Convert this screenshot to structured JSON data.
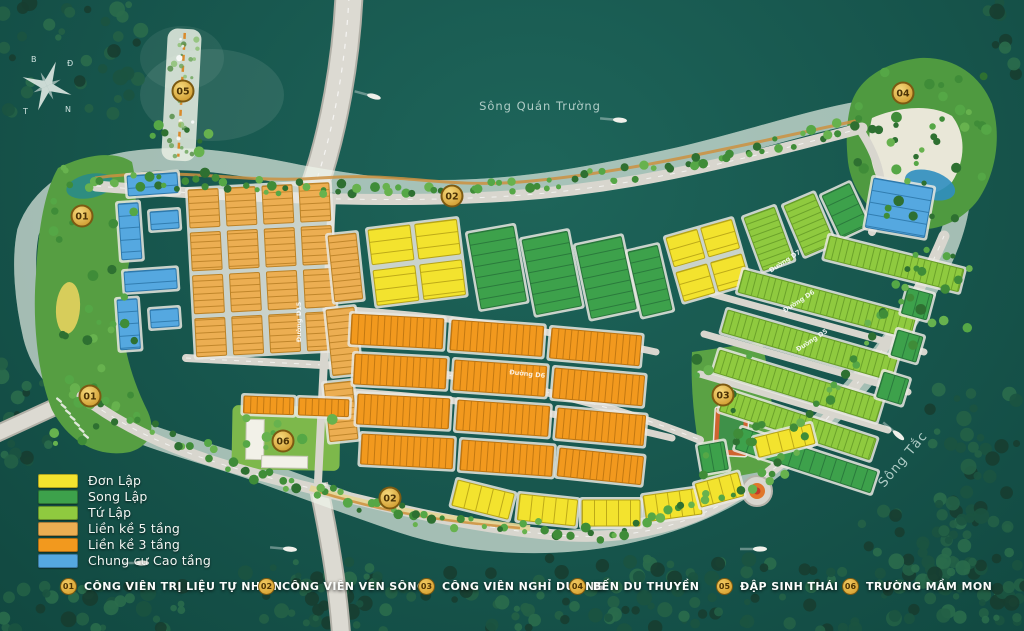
{
  "water_labels": [
    {
      "text": "Sông Quán Trường",
      "x": 540,
      "y": 110,
      "rot": 0,
      "size": 11.5
    },
    {
      "text": "Sông Tắc",
      "x": 906,
      "y": 462,
      "rot": -50,
      "size": 13
    }
  ],
  "compass": {
    "n": "B",
    "e": "Đ",
    "s": "N",
    "w": "T"
  },
  "legend": {
    "items": [
      {
        "type": "don_lap",
        "label": "Đơn Lập"
      },
      {
        "type": "song_lap",
        "label": "Song Lập"
      },
      {
        "type": "tu_lap",
        "label": "Tứ Lập"
      },
      {
        "type": "lien_ke_5",
        "label": "Liền kề 5 tầng"
      },
      {
        "type": "lien_ke_3",
        "label": "Liền kề 3 tầng"
      },
      {
        "type": "chung_cu",
        "label": "Chung cư Cao tầng"
      }
    ]
  },
  "amenities": [
    {
      "num": "01",
      "label": "CÔNG VIÊN TRỊ LIỆU TỰ NHIÊN"
    },
    {
      "num": "02",
      "label": "CÔNG VIÊN VEN SÔNG"
    },
    {
      "num": "03",
      "label": "CÔNG VIÊN NGHỈ DƯỠNG"
    },
    {
      "num": "04",
      "label": "BẾN DU THUYỀN"
    },
    {
      "num": "05",
      "label": "ĐẬP SINH THÁI"
    },
    {
      "num": "06",
      "label": "TRƯỜNG MẦM MON"
    }
  ],
  "markers": [
    {
      "num": "01",
      "x": 82,
      "y": 216
    },
    {
      "num": "01",
      "x": 90,
      "y": 396
    },
    {
      "num": "02",
      "x": 452,
      "y": 196
    },
    {
      "num": "02",
      "x": 390,
      "y": 498
    },
    {
      "num": "03",
      "x": 723,
      "y": 395
    },
    {
      "num": "04",
      "x": 903,
      "y": 93
    },
    {
      "num": "05",
      "x": 183,
      "y": 91
    },
    {
      "num": "06",
      "x": 283,
      "y": 441
    }
  ],
  "road_labels": [
    {
      "text": "Đường D15",
      "x": 301,
      "y": 322,
      "rot": -90
    },
    {
      "text": "Đường D6",
      "x": 527,
      "y": 376,
      "rot": 6
    },
    {
      "text": "Đường D7",
      "x": 786,
      "y": 263,
      "rot": -33
    },
    {
      "text": "Đường D6",
      "x": 800,
      "y": 303,
      "rot": -33
    },
    {
      "text": "Đường D5",
      "x": 813,
      "y": 342,
      "rot": -33
    }
  ],
  "colors": {
    "don_lap": {
      "fill": "#f3e32e",
      "line": "#b7a415"
    },
    "song_lap": {
      "fill": "#3da14b",
      "line": "#27763a"
    },
    "tu_lap": {
      "fill": "#8fca3f",
      "line": "#679e27"
    },
    "lien_ke_5": {
      "fill": "#ecae52",
      "line": "#bb8226"
    },
    "lien_ke_3": {
      "fill": "#f2991e",
      "line": "#bd7410"
    },
    "chung_cu": {
      "fill": "#55a8e0",
      "line": "#2d78ab"
    },
    "gold_marker": "#d8a430",
    "road": "#d6d4cc",
    "island": "#cbc9c1",
    "park": "#569e42"
  },
  "map": {
    "blocks": [
      {
        "t": "lien_ke_5",
        "x": 188,
        "y": 190,
        "cols": 4,
        "rows": 4,
        "w": 30,
        "h": 38,
        "gx": 7,
        "gy": 5,
        "rot": -3,
        "hatch": "h"
      },
      {
        "t": "chung_cu",
        "x": 127,
        "y": 176,
        "w": 50,
        "h": 20,
        "rot": -4,
        "hatch": "h"
      },
      {
        "t": "chung_cu",
        "x": 118,
        "y": 204,
        "w": 20,
        "h": 56,
        "rot": -4,
        "hatch": "h"
      },
      {
        "t": "chung_cu",
        "x": 150,
        "y": 212,
        "w": 28,
        "h": 18,
        "rot": -4,
        "hatch": "h"
      },
      {
        "t": "chung_cu",
        "x": 124,
        "y": 272,
        "w": 52,
        "h": 20,
        "rot": -4,
        "hatch": "h"
      },
      {
        "t": "chung_cu",
        "x": 117,
        "y": 300,
        "w": 20,
        "h": 50,
        "rot": -4,
        "hatch": "h"
      },
      {
        "t": "chung_cu",
        "x": 150,
        "y": 310,
        "w": 28,
        "h": 18,
        "rot": -4,
        "hatch": "h"
      },
      {
        "t": "lien_ke_5",
        "x": 328,
        "y": 236,
        "w": 28,
        "h": 66,
        "rot": -6,
        "hatch": "h"
      },
      {
        "t": "lien_ke_5",
        "x": 326,
        "y": 310,
        "w": 28,
        "h": 66,
        "rot": -6,
        "hatch": "h"
      },
      {
        "t": "lien_ke_5",
        "x": 324,
        "y": 384,
        "w": 28,
        "h": 58,
        "rot": -6,
        "hatch": "h"
      },
      {
        "t": "don_lap",
        "x": 368,
        "y": 230,
        "cols": 2,
        "rows": 2,
        "w": 42,
        "h": 35,
        "gx": 5,
        "gy": 6,
        "rot": -7,
        "hatch": "h"
      },
      {
        "t": "song_lap",
        "x": 468,
        "y": 234,
        "w": 46,
        "h": 76,
        "rot": -10,
        "hatch": "h"
      },
      {
        "t": "song_lap",
        "x": 522,
        "y": 240,
        "w": 46,
        "h": 76,
        "rot": -11,
        "hatch": "h"
      },
      {
        "t": "song_lap",
        "x": 576,
        "y": 246,
        "w": 46,
        "h": 74,
        "rot": -12,
        "hatch": "h"
      },
      {
        "t": "song_lap",
        "x": 628,
        "y": 252,
        "w": 30,
        "h": 66,
        "rot": -13,
        "hatch": "h"
      },
      {
        "t": "don_lap",
        "x": 666,
        "y": 238,
        "cols": 2,
        "rows": 2,
        "w": 32,
        "h": 30,
        "gx": 4,
        "gy": 6,
        "rot": -16,
        "hatch": "h"
      },
      {
        "t": "tu_lap",
        "x": 744,
        "y": 218,
        "w": 32,
        "h": 56,
        "rot": -20,
        "hatch": "h"
      },
      {
        "t": "tu_lap",
        "x": 784,
        "y": 206,
        "w": 32,
        "h": 54,
        "rot": -23,
        "hatch": "h"
      },
      {
        "t": "song_lap",
        "x": 822,
        "y": 196,
        "w": 30,
        "h": 46,
        "rot": -25,
        "hatch": "h"
      },
      {
        "t": "tu_lap",
        "x": 830,
        "y": 236,
        "w": 138,
        "h": 23,
        "rot": 14,
        "hatch": "v"
      },
      {
        "t": "tu_lap",
        "x": 744,
        "y": 270,
        "w": 178,
        "h": 23,
        "rot": 15,
        "hatch": "v"
      },
      {
        "t": "tu_lap",
        "x": 728,
        "y": 310,
        "w": 176,
        "h": 23,
        "rot": 16,
        "hatch": "v"
      },
      {
        "t": "tu_lap",
        "x": 720,
        "y": 350,
        "w": 170,
        "h": 23,
        "rot": 17,
        "hatch": "v"
      },
      {
        "t": "tu_lap",
        "x": 726,
        "y": 390,
        "w": 158,
        "h": 22,
        "rot": 18,
        "hatch": "v"
      },
      {
        "t": "song_lap",
        "x": 742,
        "y": 428,
        "w": 142,
        "h": 22,
        "rot": 18,
        "hatch": "v"
      },
      {
        "t": "song_lap",
        "x": 908,
        "y": 288,
        "w": 26,
        "h": 26,
        "rot": 15,
        "hatch": "v"
      },
      {
        "t": "song_lap",
        "x": 898,
        "y": 330,
        "w": 26,
        "h": 26,
        "rot": 16,
        "hatch": "v"
      },
      {
        "t": "song_lap",
        "x": 884,
        "y": 372,
        "w": 26,
        "h": 26,
        "rot": 17,
        "hatch": "v"
      },
      {
        "t": "don_lap",
        "x": 458,
        "y": 480,
        "w": 58,
        "h": 26,
        "rot": 14,
        "hatch": "v"
      },
      {
        "t": "don_lap",
        "x": 520,
        "y": 494,
        "w": 58,
        "h": 26,
        "rot": 6,
        "hatch": "v"
      },
      {
        "t": "don_lap",
        "x": 582,
        "y": 500,
        "w": 58,
        "h": 26,
        "rot": 0,
        "hatch": "v"
      },
      {
        "t": "don_lap",
        "x": 643,
        "y": 496,
        "w": 56,
        "h": 26,
        "rot": -8,
        "hatch": "v"
      },
      {
        "t": "don_lap",
        "x": 695,
        "y": 484,
        "w": 44,
        "h": 24,
        "rot": -15,
        "hatch": "v"
      },
      {
        "t": "song_lap",
        "x": 698,
        "y": 446,
        "w": 26,
        "h": 28,
        "rot": -10,
        "hatch": "v"
      },
      {
        "t": "don_lap",
        "x": 754,
        "y": 438,
        "w": 58,
        "h": 20,
        "rot": -14,
        "hatch": "v"
      },
      {
        "t": "lien_ke_3",
        "x": 352,
        "y": 314,
        "w": 92,
        "h": 30,
        "rot": 3,
        "hatch": "v"
      },
      {
        "t": "lien_ke_3",
        "x": 452,
        "y": 320,
        "w": 92,
        "h": 30,
        "rot": 4,
        "hatch": "v"
      },
      {
        "t": "lien_ke_3",
        "x": 552,
        "y": 328,
        "w": 90,
        "h": 30,
        "rot": 5,
        "hatch": "v"
      },
      {
        "t": "lien_ke_3",
        "x": 355,
        "y": 354,
        "w": 92,
        "h": 30,
        "rot": 3,
        "hatch": "v"
      },
      {
        "t": "lien_ke_3",
        "x": 455,
        "y": 360,
        "w": 92,
        "h": 30,
        "rot": 4,
        "hatch": "v"
      },
      {
        "t": "lien_ke_3",
        "x": 555,
        "y": 368,
        "w": 90,
        "h": 30,
        "rot": 5,
        "hatch": "v"
      },
      {
        "t": "lien_ke_3",
        "x": 358,
        "y": 394,
        "w": 92,
        "h": 30,
        "rot": 3,
        "hatch": "v"
      },
      {
        "t": "lien_ke_3",
        "x": 458,
        "y": 400,
        "w": 92,
        "h": 30,
        "rot": 4,
        "hatch": "v"
      },
      {
        "t": "lien_ke_3",
        "x": 558,
        "y": 408,
        "w": 88,
        "h": 30,
        "rot": 5,
        "hatch": "v"
      },
      {
        "t": "lien_ke_3",
        "x": 362,
        "y": 434,
        "w": 92,
        "h": 30,
        "rot": 3,
        "hatch": "v"
      },
      {
        "t": "lien_ke_3",
        "x": 462,
        "y": 440,
        "w": 92,
        "h": 30,
        "rot": 4,
        "hatch": "v"
      },
      {
        "t": "lien_ke_3",
        "x": 560,
        "y": 448,
        "w": 84,
        "h": 28,
        "rot": 6,
        "hatch": "v"
      },
      {
        "t": "lien_ke_3",
        "x": 244,
        "y": 396,
        "w": 50,
        "h": 17,
        "rot": 2,
        "hatch": "v"
      },
      {
        "t": "lien_ke_3",
        "x": 299,
        "y": 398,
        "w": 50,
        "h": 17,
        "rot": 2,
        "hatch": "v"
      },
      {
        "t": "chung_cu",
        "x": 874,
        "y": 178,
        "w": 60,
        "h": 50,
        "rot": 10,
        "hatch": "h"
      }
    ]
  }
}
